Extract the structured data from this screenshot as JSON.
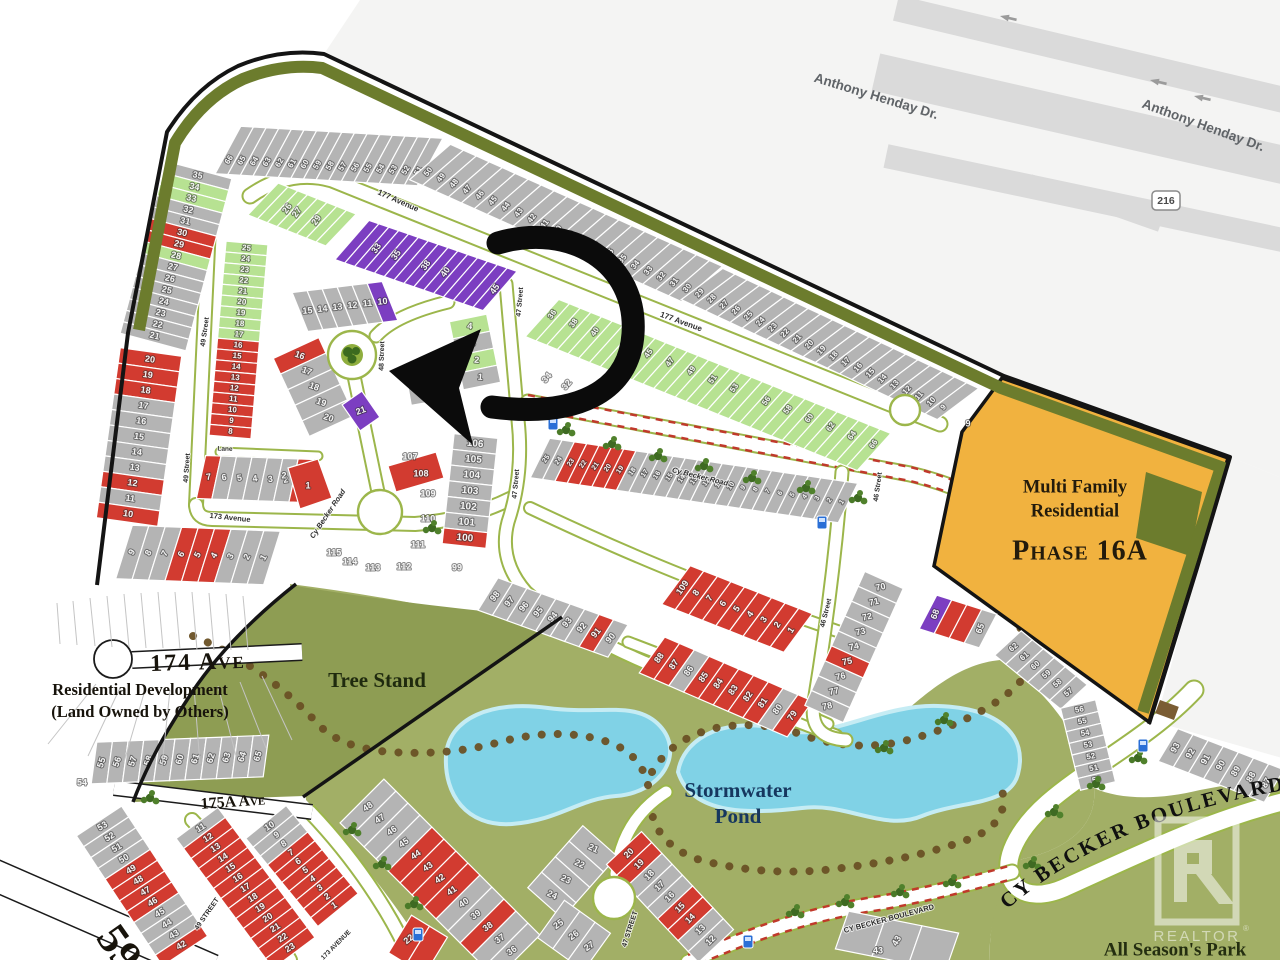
{
  "title": "Cy Becker community lot map",
  "colors": {
    "page_bg": "#ffffff",
    "outside_bg": "#f4f4f3",
    "highway_band": "#dadada",
    "highway_text": "#606468",
    "lot_gray": "#b4b4b4",
    "lot_red": "#d23b30",
    "lot_green": "#b7e292",
    "lot_purple": "#7c3ec1",
    "lot_line": "#ffffff",
    "lot_number": "#f4f4f4",
    "park_green": "#a2af66",
    "tree_stand_green": "#8e9d53",
    "pond_blue": "#80d2e6",
    "pond_edge": "#c5ecf4",
    "olive_band": "#6c7c2d",
    "orange_phase": "#f1b23f",
    "road_white": "#ffffff",
    "verge_green": "#9cb64b",
    "boundary_black": "#141414",
    "trail_brown": "#6a5125",
    "hatch_red": "#c0392b",
    "street_text": "#2e2e2e",
    "serif_dark": "#17130b",
    "bus_blue": "#2a6fd6"
  },
  "highway": {
    "label_a": "Anthony Henday Dr.",
    "label_b": "Anthony Henday Dr.",
    "shield": "216"
  },
  "watermark": {
    "brand": "REALTOR",
    "registered": "®"
  },
  "annotation": {
    "type": "curved-arrow",
    "target_lot": "6"
  },
  "area_labels": [
    {
      "name": "highway-label-1",
      "t": "Anthony Henday Dr.",
      "x": 876,
      "y": 97,
      "fs": 13.5,
      "rot": 17,
      "color": "#606468",
      "font": "sans",
      "w": 700
    },
    {
      "name": "highway-label-2",
      "t": "Anthony Henday Dr.",
      "x": 1203,
      "y": 126,
      "fs": 13.5,
      "rot": 20,
      "color": "#606468",
      "font": "sans",
      "w": 700
    },
    {
      "name": "label-174-ave",
      "t": "174 Ave",
      "x": 198,
      "y": 664,
      "fs": 24,
      "rot": -2,
      "sc": true,
      "ls": 2
    },
    {
      "name": "label-res-dev-1",
      "t": "Residential Development",
      "x": 140,
      "y": 691,
      "fs": 16.5
    },
    {
      "name": "label-res-dev-2",
      "t": "(Land Owned by Others)",
      "x": 140,
      "y": 713,
      "fs": 16.5
    },
    {
      "name": "label-175a-ave",
      "t": "175A Ave",
      "x": 233,
      "y": 803,
      "fs": 16,
      "rot": -4,
      "sc": true
    },
    {
      "name": "label-tree-stand",
      "t": "Tree Stand",
      "x": 377,
      "y": 682,
      "fs": 21,
      "color": "#1f2a0e"
    },
    {
      "name": "label-stormwater",
      "t": "Stormwater",
      "x": 738,
      "y": 792,
      "fs": 21,
      "color": "#16375f"
    },
    {
      "name": "label-pond",
      "t": "Pond",
      "x": 738,
      "y": 818,
      "fs": 21,
      "color": "#16375f"
    },
    {
      "name": "label-mf-1",
      "t": "Multi Family",
      "x": 1075,
      "y": 488,
      "fs": 18.5,
      "color": "#231b0c"
    },
    {
      "name": "label-mf-2",
      "t": "Residential",
      "x": 1075,
      "y": 512,
      "fs": 18.5,
      "color": "#231b0c"
    },
    {
      "name": "label-phase",
      "t": "Phase 16A",
      "x": 1080,
      "y": 553,
      "fs": 28,
      "sc": true,
      "ls": 1,
      "color": "#231b0c"
    },
    {
      "name": "label-all-seasons",
      "t": "All Season's Park",
      "x": 1175,
      "y": 951,
      "fs": 19,
      "color": "#242e10"
    },
    {
      "name": "label-59-street",
      "t": "59",
      "x": 116,
      "y": 950,
      "fs": 44,
      "rot": 55
    }
  ],
  "curved_label": {
    "name": "label-boulevard-curved",
    "t": "CY BECKER BOULEVARD"
  },
  "street_labels": [
    {
      "t": "177 Avenue",
      "x": 398,
      "y": 201,
      "fs": 8,
      "rot": 24
    },
    {
      "t": "177 Avenue",
      "x": 681,
      "y": 322,
      "fs": 8,
      "rot": 20
    },
    {
      "t": "49 Street",
      "x": 205,
      "y": 332,
      "fs": 7,
      "rot": -82
    },
    {
      "t": "49 Street",
      "x": 187,
      "y": 468,
      "fs": 7,
      "rot": -86
    },
    {
      "t": "48 Street",
      "x": 382,
      "y": 356,
      "fs": 7,
      "rot": -88
    },
    {
      "t": "47 Street",
      "x": 520,
      "y": 302,
      "fs": 7,
      "rot": -85
    },
    {
      "t": "47 Street",
      "x": 516,
      "y": 484,
      "fs": 7,
      "rot": -85
    },
    {
      "t": "46 Street",
      "x": 878,
      "y": 487,
      "fs": 7,
      "rot": -82
    },
    {
      "t": "46 Street",
      "x": 826,
      "y": 613,
      "fs": 7,
      "rot": -76
    },
    {
      "t": "173 Avenue",
      "x": 230,
      "y": 518,
      "fs": 7.5,
      "rot": 6
    },
    {
      "t": "Lane",
      "x": 225,
      "y": 449,
      "fs": 6.5,
      "rot": 2
    },
    {
      "t": "Cy Becker Road",
      "x": 328,
      "y": 514,
      "fs": 7.5,
      "rot": -56,
      "it": true
    },
    {
      "t": "Cy Becker Road",
      "x": 700,
      "y": 477,
      "fs": 7.5,
      "rot": 14,
      "it": true
    },
    {
      "t": "49 STREET",
      "x": 207,
      "y": 914,
      "fs": 7,
      "rot": -55
    },
    {
      "t": "47 STREET",
      "x": 630,
      "y": 929,
      "fs": 7,
      "rot": -72
    },
    {
      "t": "173 AVENUE",
      "x": 336,
      "y": 945,
      "fs": 6.5,
      "rot": -45
    },
    {
      "t": "CY BECKER BOULEVARD",
      "x": 889,
      "y": 919,
      "fs": 7.5,
      "rot": -15
    }
  ],
  "blocks": [
    {
      "name": "block-top-arc-a",
      "range": [
        66,
        51
      ],
      "fs": 8
    },
    {
      "name": "block-top-arc-b",
      "range": [
        50,
        30
      ],
      "fs": 8
    },
    {
      "name": "block-top-arc-c",
      "range": [
        29,
        9
      ],
      "fs": 8
    },
    {
      "name": "block-west-col-a",
      "range": [
        35,
        21
      ],
      "fills": {
        "34": "G",
        "33": "G",
        "30": "R",
        "29": "R",
        "28": "G"
      },
      "fs": 9
    },
    {
      "name": "block-west-col-b",
      "range": [
        20,
        10
      ],
      "fills": {
        "20": "R",
        "19": "R",
        "18": "R",
        "12": "R",
        "10": "R"
      },
      "fs": 9
    },
    {
      "name": "block-west-row-s",
      "range": [
        9,
        1
      ],
      "fills": {
        "6": "R",
        "5": "R",
        "4": "R"
      },
      "fs": 9
    },
    {
      "name": "block-49st-east",
      "range": [
        25,
        8
      ],
      "fills": {
        "25": "G",
        "24": "G",
        "23": "G",
        "22": "G",
        "21": "G",
        "20": "G",
        "19": "G",
        "18": "G",
        "17": "G",
        "16": "R",
        "15": "R",
        "14": "R",
        "13": "R",
        "12": "R",
        "11": "R",
        "10": "R",
        "9": "R",
        "8": "R"
      },
      "fs": 8
    },
    {
      "name": "block-lane-row",
      "range": [
        7,
        1
      ],
      "fills": {
        "7": "R",
        "1": "R"
      },
      "fs": 9
    },
    {
      "name": "block-green-nw",
      "range": [
        24,
        31
      ],
      "fillsAll": "G",
      "labels": [
        26,
        27,
        29
      ],
      "fs": 9
    },
    {
      "name": "block-purple-row",
      "range": [
        31,
        45
      ],
      "fillsAll": "P",
      "labels": [
        33,
        35,
        38,
        40,
        45
      ],
      "fs": 9
    },
    {
      "name": "block-fan-north",
      "nums": [
        15,
        14,
        13,
        12,
        11,
        10
      ],
      "fills": {
        "10": "P"
      },
      "fs": 9
    },
    {
      "name": "block-fan-west",
      "nums": [
        16,
        17,
        18,
        19,
        20
      ],
      "fills": {
        "16": "R"
      },
      "fs": 9
    },
    {
      "name": "block-lot-21",
      "nums": [
        21
      ],
      "fillsAll": "P",
      "fs": 9
    },
    {
      "name": "block-lot-6",
      "nums": [
        6,
        5
      ],
      "fills": {
        "6": "P"
      },
      "fs": 9
    },
    {
      "name": "block-lots-1-4",
      "nums": [
        4,
        3,
        2,
        1
      ],
      "fills": {
        "4": "G",
        "2": "G"
      },
      "fs": 9
    },
    {
      "name": "block-green-row-36-66",
      "range": [
        36,
        66
      ],
      "fillsAll": "G",
      "labels": [
        36,
        38,
        40,
        43,
        45,
        47,
        49,
        51,
        53,
        56,
        58,
        60,
        62,
        64,
        66
      ],
      "fs": 8
    },
    {
      "name": "block-row-se",
      "range": [
        25,
        1
      ],
      "fills": {
        "23": "R",
        "22": "R",
        "21": "R",
        "20": "R",
        "19": "R"
      },
      "fs": 7
    },
    {
      "name": "block-red-row-a",
      "nums": [
        109,
        8,
        7,
        6,
        5,
        4,
        3,
        2,
        1
      ],
      "fillsAll": "R",
      "fs": 9
    },
    {
      "name": "block-red-row-b",
      "nums": [
        88,
        87,
        86,
        85,
        84,
        83,
        82,
        81,
        80,
        79
      ],
      "fills": {
        "88": "R",
        "87": "R",
        "85": "R",
        "84": "R",
        "83": "R",
        "82": "R",
        "81": "R",
        "79": "R"
      },
      "fs": 9
    },
    {
      "name": "block-col-70",
      "range": [
        70,
        78
      ],
      "fills": {
        "75": "R"
      },
      "fs": 9
    },
    {
      "name": "block-68",
      "nums": [
        68,
        67,
        66,
        65
      ],
      "fills": {
        "68": "P",
        "67": "R",
        "66": "R"
      },
      "labels": [
        68,
        65
      ],
      "fs": 9
    },
    {
      "name": "block-ne-a",
      "nums": [
        62,
        61,
        60,
        59,
        58,
        57
      ],
      "fs": 8
    },
    {
      "name": "block-ne-b",
      "nums": [
        56,
        55,
        54,
        53,
        52,
        51,
        50
      ],
      "fs": 8
    },
    {
      "name": "block-east-col",
      "nums": [
        93,
        92,
        91,
        90,
        89,
        88,
        87
      ],
      "fs": 9
    },
    {
      "name": "block-bot-48",
      "range": [
        48,
        36
      ],
      "fills": {
        "44": "R",
        "43": "R",
        "42": "R",
        "41": "R",
        "38": "R"
      },
      "fs": 9
    },
    {
      "name": "block-fan-bw1",
      "nums": [
        21,
        22,
        23,
        24
      ],
      "fs": 9
    },
    {
      "name": "block-fan-bw2",
      "nums": [
        25,
        26,
        27
      ],
      "fs": 9
    },
    {
      "name": "block-fan-be",
      "nums": [
        20,
        19,
        18,
        17,
        16,
        15,
        14,
        13,
        12
      ],
      "fills": {
        "20": "R",
        "19": "R",
        "15": "R",
        "14": "R"
      },
      "fs": 9
    },
    {
      "name": "block-row-55",
      "range": [
        55,
        65
      ],
      "fs": 9
    },
    {
      "name": "block-col-a",
      "range": [
        53,
        42
      ],
      "fills": {
        "49": "R",
        "48": "R",
        "47": "R",
        "46": "R",
        "42": "R"
      },
      "fs": 9
    },
    {
      "name": "block-col-b",
      "range": [
        11,
        23
      ],
      "fills": {
        "12": "R",
        "13": "R",
        "14": "R",
        "15": "R",
        "16": "R",
        "17": "R",
        "18": "R",
        "19": "R",
        "20": "R",
        "21": "R",
        "22": "R",
        "23": "R"
      },
      "fs": 9
    },
    {
      "name": "block-col-c",
      "nums": [
        10,
        9,
        8,
        7,
        6,
        5,
        4,
        3,
        2,
        1
      ],
      "fills": {
        "7": "R",
        "6": "R",
        "5": "R",
        "4": "R",
        "3": "R",
        "2": "R",
        "1": "R"
      },
      "fs": 9
    },
    {
      "name": "block-col-106",
      "nums": [
        106,
        105,
        104,
        103,
        102,
        101,
        100
      ],
      "fills": {
        "100": "R"
      },
      "fs": 10
    },
    {
      "name": "block-row-97",
      "nums": [
        98,
        97,
        96,
        95,
        94,
        93,
        92,
        91,
        90
      ],
      "fills": {
        "91": "R"
      },
      "fs": 9
    },
    {
      "name": "block-col-d",
      "nums": [
        22,
        23
      ],
      "fillsAll": "R",
      "labels": [
        22
      ],
      "fs": 9
    },
    {
      "name": "block-bot-43",
      "nums": [
        44,
        43,
        42
      ],
      "labels": [
        43
      ],
      "fs": 9
    }
  ],
  "loose_numbers": [
    {
      "t": "34",
      "x": 547,
      "y": 378,
      "rot": -50
    },
    {
      "t": "32",
      "x": 567,
      "y": 385,
      "rot": -50
    },
    {
      "t": "30",
      "x": 587,
      "y": 393,
      "rot": -50
    },
    {
      "t": "99",
      "x": 457,
      "y": 568
    },
    {
      "t": "107",
      "x": 410,
      "y": 457
    },
    {
      "t": "108",
      "x": 421,
      "y": 474
    },
    {
      "t": "109",
      "x": 428,
      "y": 494
    },
    {
      "t": "110",
      "x": 428,
      "y": 519
    },
    {
      "t": "111",
      "x": 418,
      "y": 545
    },
    {
      "t": "112",
      "x": 404,
      "y": 567
    },
    {
      "t": "113",
      "x": 373,
      "y": 568
    },
    {
      "t": "114",
      "x": 350,
      "y": 562
    },
    {
      "t": "115",
      "x": 334,
      "y": 553
    },
    {
      "t": "1",
      "x": 308,
      "y": 486
    },
    {
      "t": "2",
      "x": 284,
      "y": 476
    },
    {
      "t": "54",
      "x": 82,
      "y": 783
    },
    {
      "t": "43",
      "x": 878,
      "y": 951
    },
    {
      "t": "9",
      "x": 968,
      "y": 424
    }
  ]
}
